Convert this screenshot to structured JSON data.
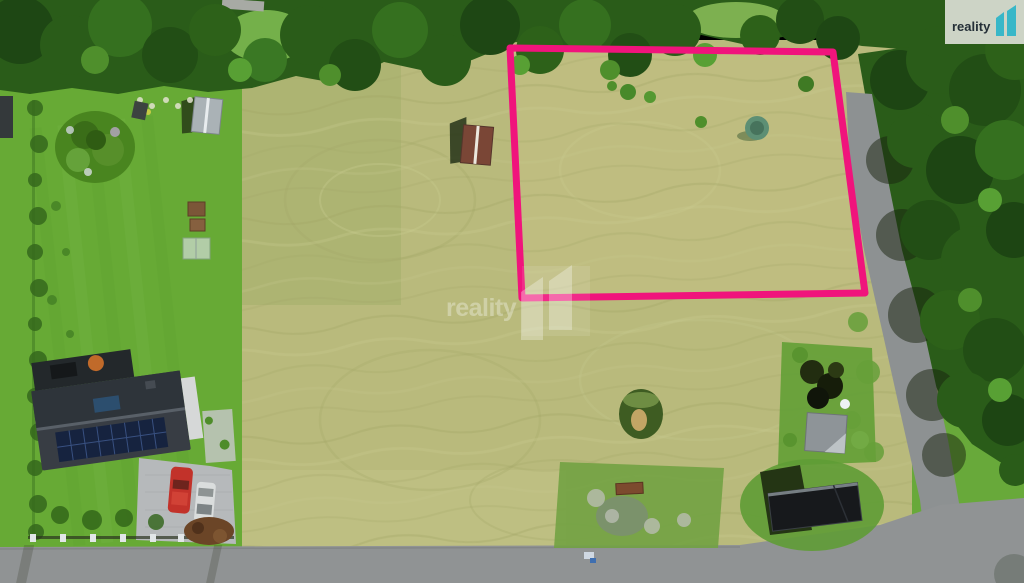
{
  "branding": {
    "name": "reality 11",
    "badge": {
      "text": "reality",
      "numeral": "11",
      "bg_color": "#cdd4c6",
      "text_color": "#242f37",
      "accent_color": "#38b7c8"
    }
  },
  "watermark": {
    "text": "reality",
    "numeral": "11",
    "color": "#ffffff",
    "opacity": 0.32
  },
  "parcel_outline": {
    "color": "#f0147c",
    "stroke_width": 7,
    "points": "510,48 833,52 865,293 522,298"
  },
  "scene": {
    "description": "Aerial drone photo of mown grass land plots; the offered parcel outlined in pink; family house with solar roof, gardens and sheds on the left; forest edge and gravel road on the right; asphalt road along the bottom.",
    "palette": {
      "hay_field": "#b9ba7c",
      "lawn": "#67aa35",
      "trees": "#2a5c19",
      "road": "#8d9192",
      "asphalt": "#909394",
      "house_roof": "#383d44",
      "solar_panels": "#16233f",
      "red_car": "#c2322a",
      "field_shed_roof": "#7a4636",
      "grey_shed_roof": "#8e9498",
      "black_shed": "#17191c"
    }
  }
}
